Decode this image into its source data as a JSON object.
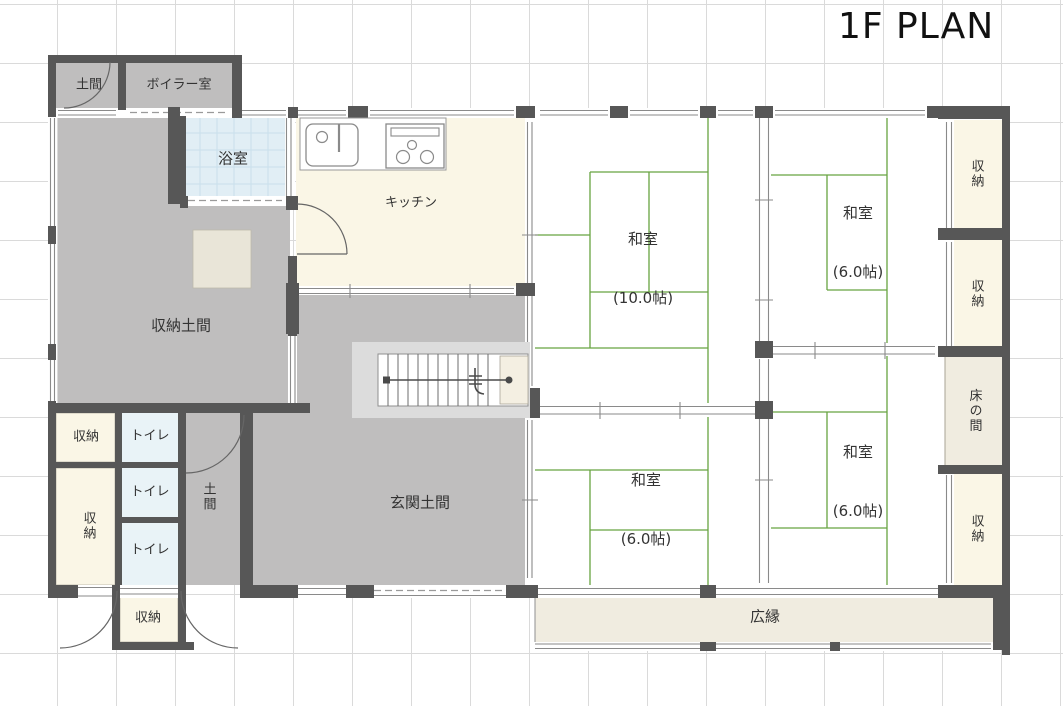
{
  "title": "1F PLAN",
  "colors": {
    "wall": "#575757",
    "doma_gray": "#bfbebe",
    "cream": "#faf6e6",
    "beige": "#f0ece0",
    "bath_blue": "#e1eef5",
    "toilet_blue": "#e9f3f7",
    "tatami_line": "#68a341",
    "grid": "#dadada",
    "stair_frame": "#dcdcdc"
  },
  "rooms": {
    "doma_top_left": {
      "label": "土間"
    },
    "boiler": {
      "label": "ボイラー室"
    },
    "bath": {
      "label": "浴室"
    },
    "kitchen": {
      "label": "キッチン"
    },
    "storage_doma": {
      "label": "収納土間"
    },
    "storage_left_upper": {
      "label": "収納"
    },
    "storage_left_lower": {
      "label": "収納"
    },
    "toilet_1": {
      "label": "トイレ"
    },
    "toilet_2": {
      "label": "トイレ"
    },
    "toilet_3": {
      "label": "トイレ"
    },
    "doma_small": {
      "label": "土間"
    },
    "genkan_doma": {
      "label": "玄関土間"
    },
    "storage_porch": {
      "label": "収納"
    },
    "washitsu_large": {
      "label": "和室",
      "size": "(10.0帖)"
    },
    "washitsu_top_right": {
      "label": "和室",
      "size": "(6.0帖)"
    },
    "washitsu_bottom_left": {
      "label": "和室",
      "size": "(6.0帖)"
    },
    "washitsu_bottom_right": {
      "label": "和室",
      "size": "(6.0帖)"
    },
    "storage_right_1": {
      "label": "収納"
    },
    "storage_right_2": {
      "label": "収納"
    },
    "tokonoma": {
      "label": "床の間"
    },
    "storage_right_3": {
      "label": "収納"
    },
    "hiroen": {
      "label": "広縁"
    }
  }
}
